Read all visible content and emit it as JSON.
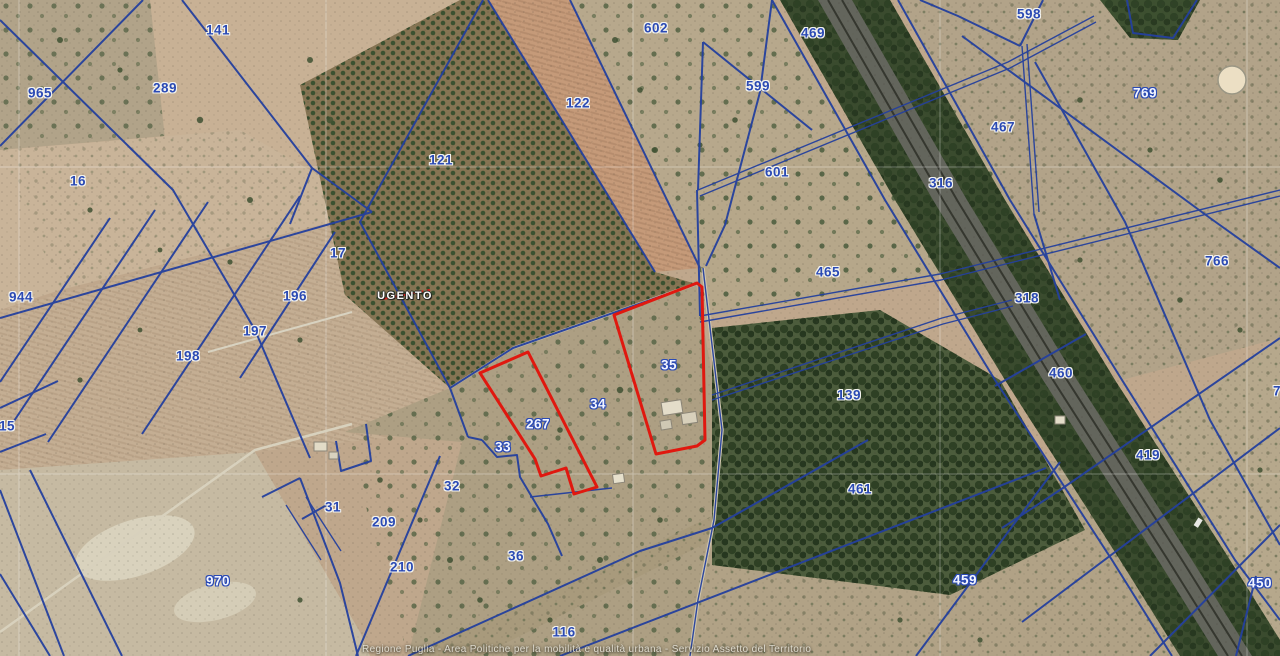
{
  "map": {
    "municipality_label": "UGENTO",
    "attribution": "Regione Puglia - Area Politiche per la mobilità e qualità urbana - Servizio Assetto del Territorio",
    "colors": {
      "boundary_blue": "#24409e",
      "highlight_red": "#e0180f",
      "label_blue": "#2b4ab4",
      "label_outline_fill": "#f2f5ff"
    },
    "highlighted_parcels": [
      "267",
      "35"
    ],
    "parcel_labels": [
      {
        "label": "141",
        "x": 218,
        "y": 30,
        "style": "blue"
      },
      {
        "label": "965",
        "x": 40,
        "y": 93,
        "style": "blue"
      },
      {
        "label": "289",
        "x": 165,
        "y": 88,
        "style": "blue"
      },
      {
        "label": "16",
        "x": 78,
        "y": 181,
        "style": "blue"
      },
      {
        "label": "17",
        "x": 338,
        "y": 253,
        "style": "blue"
      },
      {
        "label": "944",
        "x": 21,
        "y": 297,
        "style": "blue"
      },
      {
        "label": "196",
        "x": 295,
        "y": 296,
        "style": "blue"
      },
      {
        "label": "197",
        "x": 255,
        "y": 331,
        "style": "blue"
      },
      {
        "label": "198",
        "x": 188,
        "y": 356,
        "style": "blue"
      },
      {
        "label": "15",
        "x": 7,
        "y": 426,
        "style": "blue"
      },
      {
        "label": "970",
        "x": 218,
        "y": 581,
        "style": "outline"
      },
      {
        "label": "31",
        "x": 333,
        "y": 507,
        "style": "blue"
      },
      {
        "label": "32",
        "x": 452,
        "y": 486,
        "style": "blue"
      },
      {
        "label": "209",
        "x": 384,
        "y": 522,
        "style": "blue"
      },
      {
        "label": "210",
        "x": 402,
        "y": 567,
        "style": "blue"
      },
      {
        "label": "33",
        "x": 503,
        "y": 447,
        "style": "outline"
      },
      {
        "label": "267",
        "x": 538,
        "y": 424,
        "style": "outline"
      },
      {
        "label": "34",
        "x": 598,
        "y": 404,
        "style": "outline"
      },
      {
        "label": "35",
        "x": 669,
        "y": 365,
        "style": "outline"
      },
      {
        "label": "36",
        "x": 516,
        "y": 556,
        "style": "blue"
      },
      {
        "label": "116",
        "x": 564,
        "y": 632,
        "style": "blue"
      },
      {
        "label": "121",
        "x": 441,
        "y": 160,
        "style": "blue"
      },
      {
        "label": "122",
        "x": 578,
        "y": 103,
        "style": "blue"
      },
      {
        "label": "602",
        "x": 656,
        "y": 28,
        "style": "blue"
      },
      {
        "label": "469",
        "x": 813,
        "y": 33,
        "style": "blue"
      },
      {
        "label": "599",
        "x": 758,
        "y": 86,
        "style": "blue"
      },
      {
        "label": "601",
        "x": 777,
        "y": 172,
        "style": "blue"
      },
      {
        "label": "316",
        "x": 941,
        "y": 183,
        "style": "blue"
      },
      {
        "label": "598",
        "x": 1029,
        "y": 14,
        "style": "blue"
      },
      {
        "label": "467",
        "x": 1003,
        "y": 127,
        "style": "blue"
      },
      {
        "label": "769",
        "x": 1145,
        "y": 93,
        "style": "outline"
      },
      {
        "label": "465",
        "x": 828,
        "y": 272,
        "style": "blue"
      },
      {
        "label": "318",
        "x": 1027,
        "y": 298,
        "style": "blue"
      },
      {
        "label": "766",
        "x": 1217,
        "y": 261,
        "style": "blue"
      },
      {
        "label": "460",
        "x": 1061,
        "y": 373,
        "style": "blue"
      },
      {
        "label": "419",
        "x": 1148,
        "y": 455,
        "style": "blue"
      },
      {
        "label": "139",
        "x": 849,
        "y": 395,
        "style": "blue"
      },
      {
        "label": "461",
        "x": 860,
        "y": 489,
        "style": "blue"
      },
      {
        "label": "459",
        "x": 965,
        "y": 580,
        "style": "outline"
      },
      {
        "label": "450",
        "x": 1260,
        "y": 583,
        "style": "outline"
      },
      {
        "label": "7",
        "x": 1277,
        "y": 391,
        "style": "blue"
      }
    ]
  }
}
